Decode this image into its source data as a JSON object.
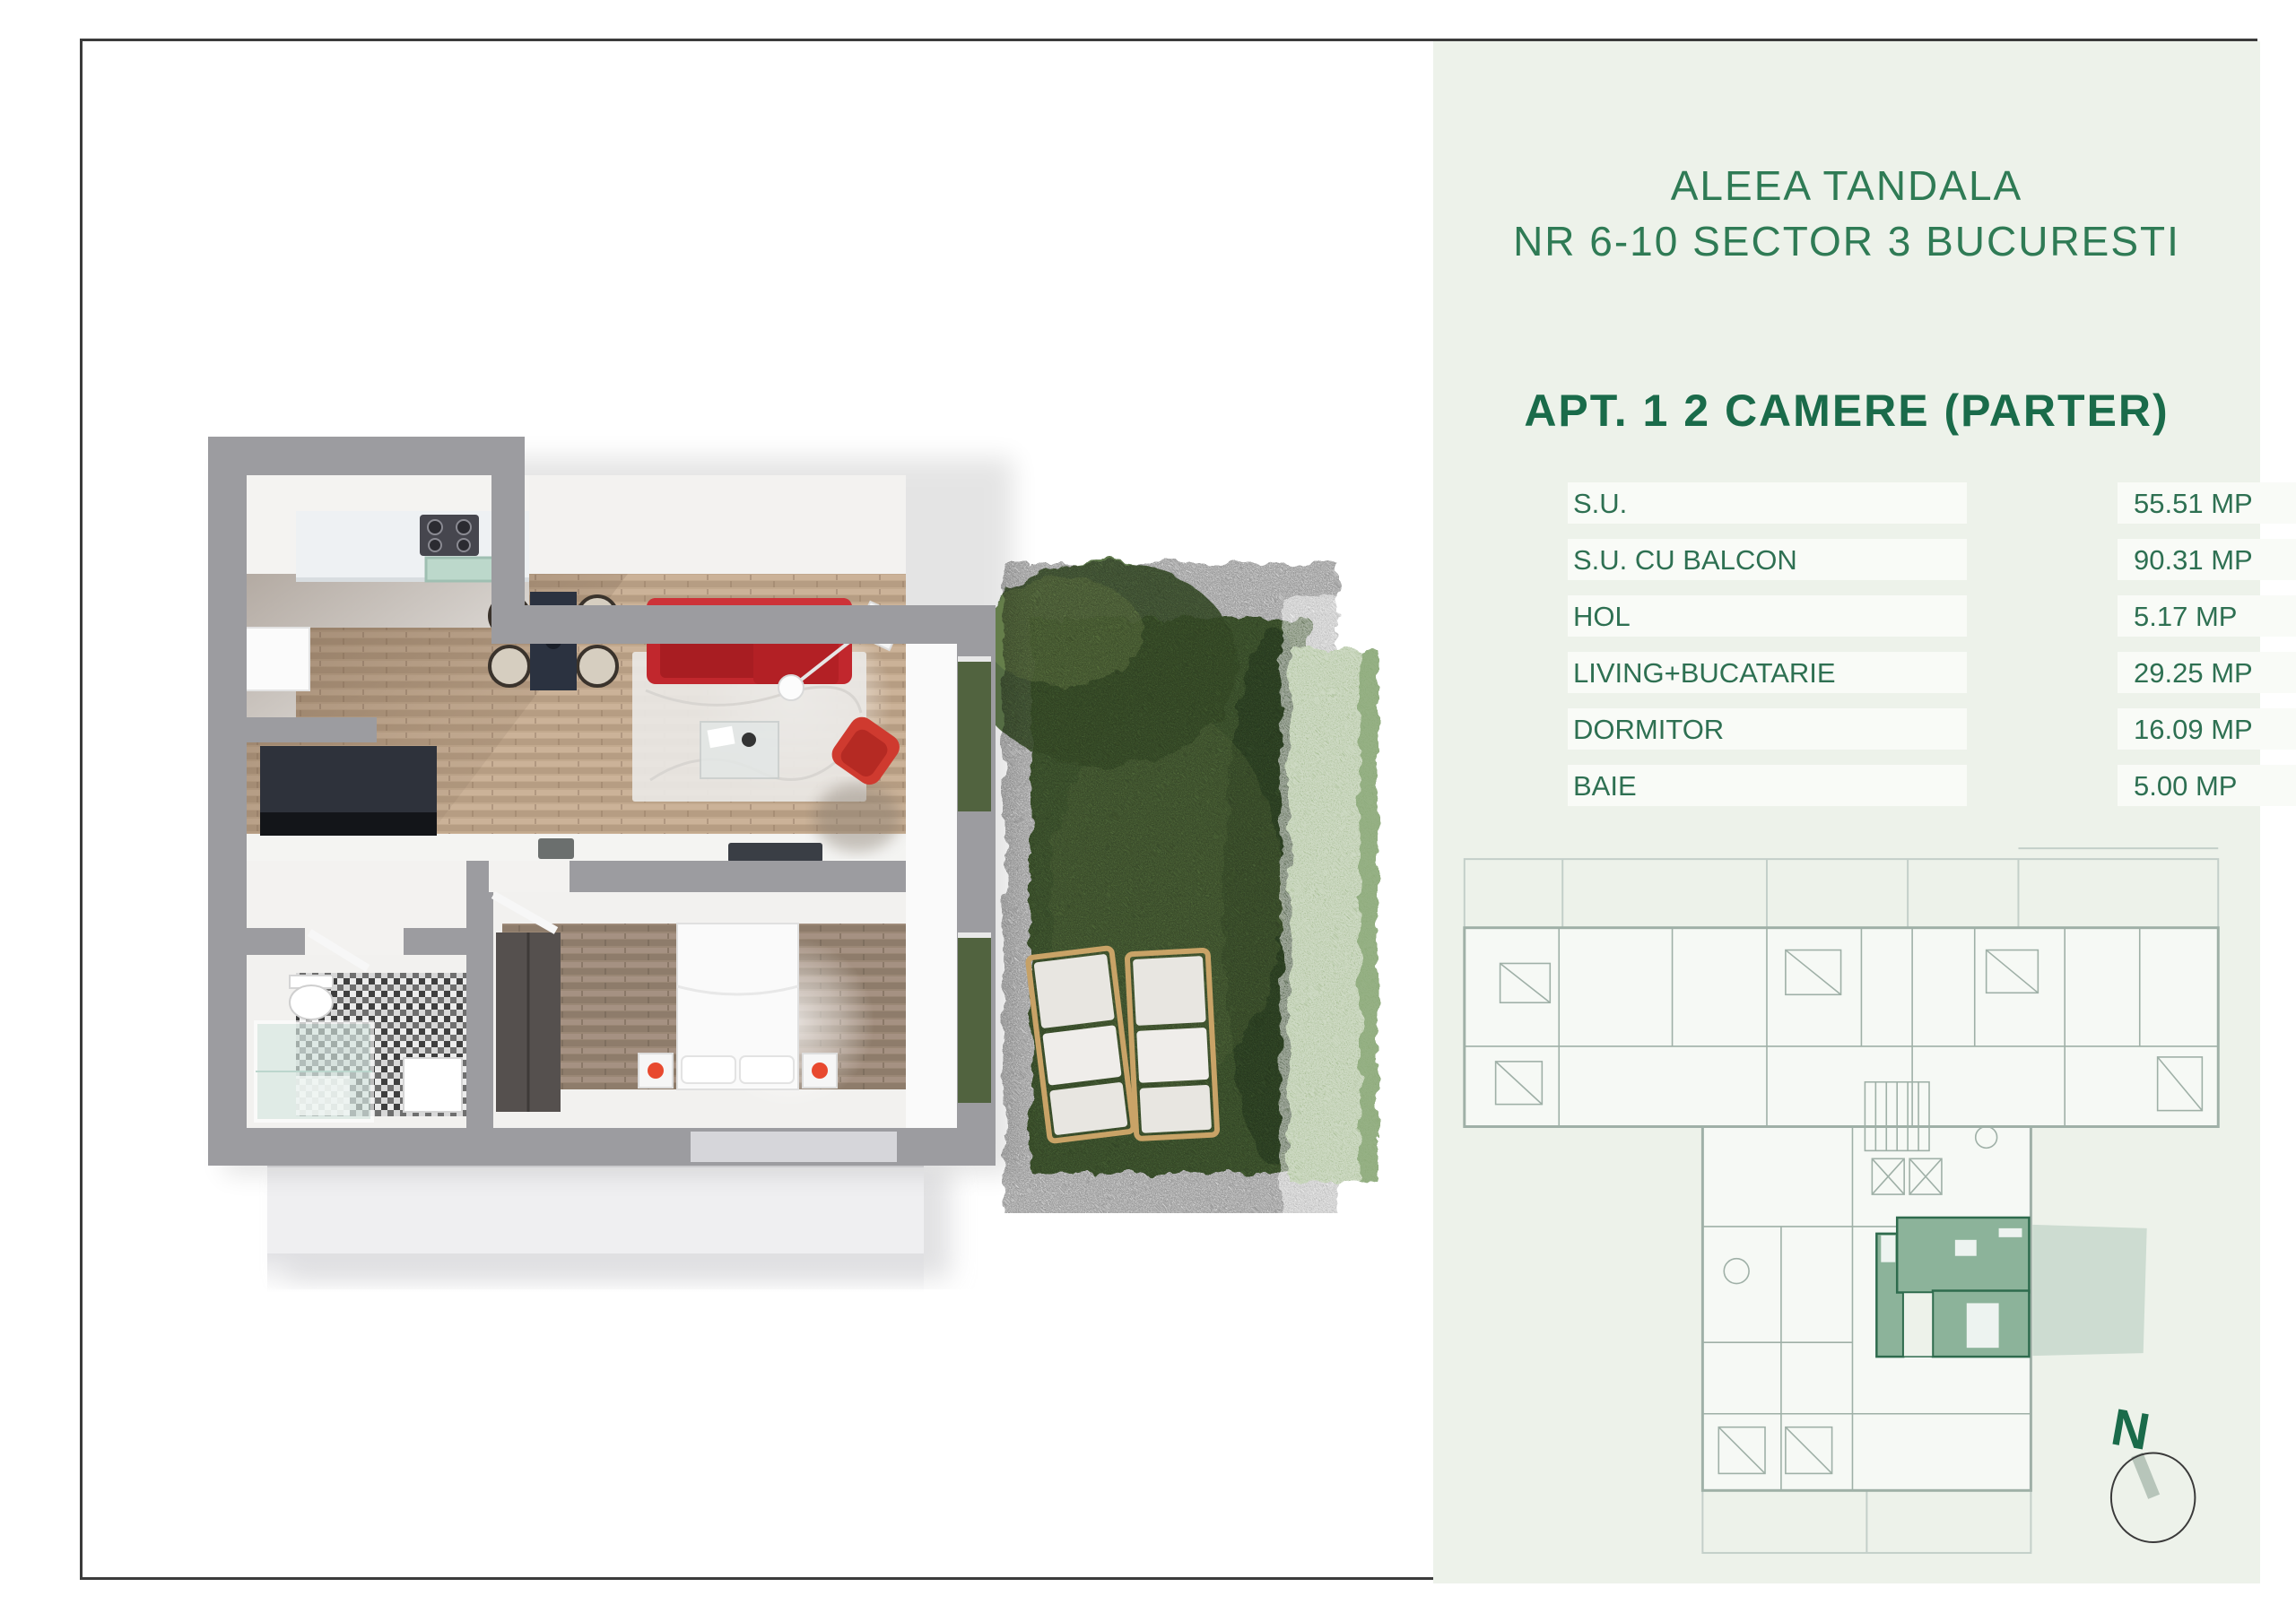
{
  "panel": {
    "title_line1": "ALEEA TANDALA",
    "title_line2": "NR 6-10 SECTOR 3 BUCURESTI",
    "subtitle": "APT. 1 2 CAMERE (PARTER)",
    "areas_table": {
      "unit": "MP",
      "rows": [
        {
          "label": "S.U.",
          "value": "55.51 MP"
        },
        {
          "label": "S.U. CU BALCON",
          "value": "90.31 MP"
        },
        {
          "label": "HOL",
          "value": "5.17 MP"
        },
        {
          "label": "LIVING+BUCATARIE",
          "value": "29.25 MP"
        },
        {
          "label": "DORMITOR",
          "value": "16.09 MP"
        },
        {
          "label": "BAIE",
          "value": "5.00 MP"
        }
      ]
    },
    "site_plan": {
      "compass_label": "N",
      "highlighted_unit": "APT. 1"
    }
  },
  "colors": {
    "border-color": "#3b3b3b",
    "panel-bg": "#edf2ea",
    "title-green": "#2f7b55",
    "subtitle-green": "#1a6b4a",
    "table-green": "#2e7052",
    "row-bg": "#f9fbf7",
    "plan-line": "#9fb0a7",
    "plan-line-light": "#c3cfc9",
    "highlight-fill": "#8cb39a",
    "highlight-stroke": "#2e6b4d",
    "garden-patch": "#cddcd1",
    "compass-needle": "#b7c5ba",
    "wall-gray": "#9c9ca0",
    "wood-floor": "#c2a98e",
    "wood-floor-dark": "#9a8775",
    "sofa-red": "#c1272d",
    "armchair-red": "#cf3a2f",
    "grass-green": "#567440",
    "hedge-green": "#93ad7c"
  }
}
